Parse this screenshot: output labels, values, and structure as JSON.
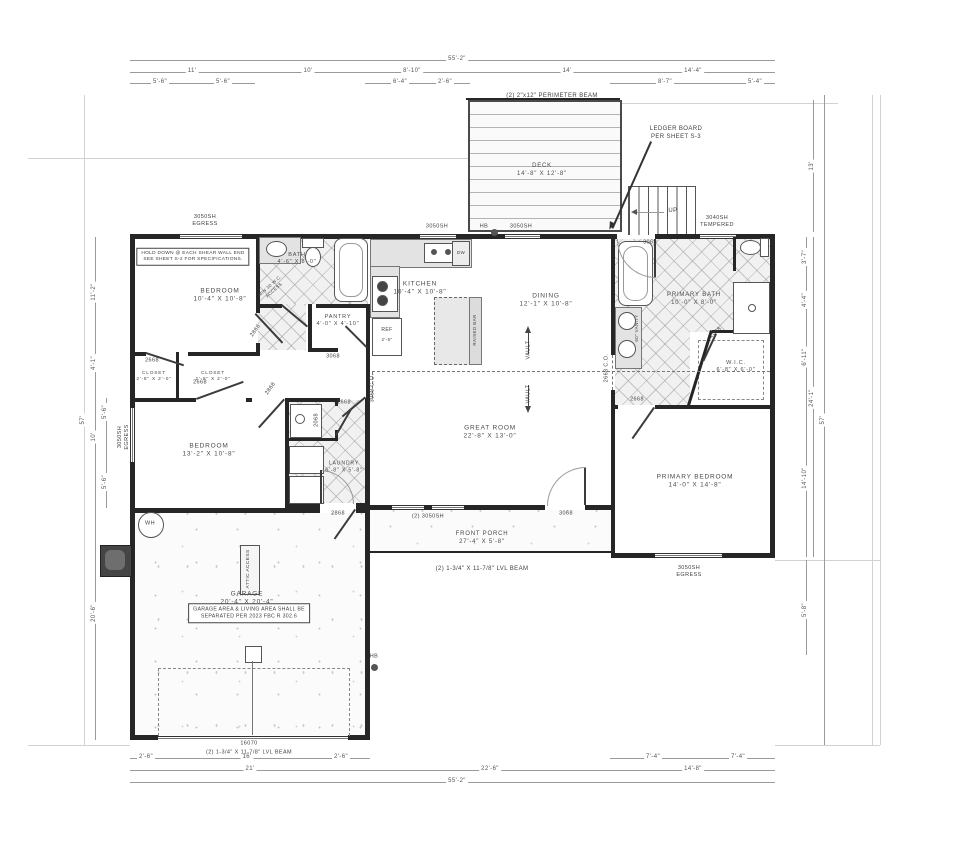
{
  "summary": {
    "rooms": [
      {
        "name": "BEDROOM",
        "size": "10'-4\" X 10'-8\""
      },
      {
        "name": "BATH",
        "size": "4'-6\" X 8'-0\""
      },
      {
        "name": "PANTRY",
        "size": "4'-0\" X 4'-10\""
      },
      {
        "name": "KITCHEN",
        "size": "10'-4\" X 10'-8\""
      },
      {
        "name": "DINING",
        "size": "12'-1\" X 10'-8\""
      },
      {
        "name": "GREAT ROOM",
        "size": "22'-8\" X 13'-0\""
      },
      {
        "name": "PRIMARY BATH",
        "size": "10'-0\" X 8'-0\""
      },
      {
        "name": "W.I.C.",
        "size": "6'-8\" X 6'-0\""
      },
      {
        "name": "PRIMARY BEDROOM",
        "size": "14'-0\" X 14'-8\""
      },
      {
        "name": "BEDROOM",
        "size": "13'-2\" X 10'-8\""
      },
      {
        "name": "CLOSET",
        "size": "2'-8\" X 2'-0\""
      },
      {
        "name": "CLOSET",
        "size": "2'-8\" X 2'-0\""
      },
      {
        "name": "LAUNDRY",
        "size": "6'-8\" X 5'-8\""
      },
      {
        "name": "GARAGE",
        "size": "20'-4\" X 20'-4\""
      },
      {
        "name": "FRONT PORCH",
        "size": "27'-4\" X 5'-8\""
      },
      {
        "name": "DECK",
        "size": "14'-8\" X 12'-8\""
      }
    ],
    "notes": [
      "HOLD DOWN @ EACH SHEAR WALL END SEE SHEET S-2 FOR SPECIFICATIONS.",
      "GARAGE AREA & LIVING AREA SHALL BE SEPARATED PER 2023 FBC R 302.6",
      "LEDGER BOARD PER SHEET S-3",
      "(2) 2\"x12\" PERIMETER BEAM",
      "(2) 1-3/4\" X 11-7/8\" LVL BEAM"
    ],
    "windows": [
      "3050SH EGRESS",
      "3050SH",
      "3040SH TEMPERED",
      "(2) 3050SH"
    ],
    "doors": [
      "3068",
      "2868",
      "2668",
      "2068",
      "16070",
      "2668 C.O.",
      "3068 C.O."
    ],
    "symbols": [
      "HB",
      "WH",
      "DW",
      "REF",
      "UP",
      "VAULT",
      "RAISED BAR",
      "ATTIC ACCESS",
      "MIN 30 W.C. ACCESS",
      "60\" VANITY"
    ]
  },
  "labels": [
    {
      "t": "55'-2\"",
      "x": 457,
      "y": 60,
      "s": 6,
      "c": "dim",
      "n": "dim-overall-top"
    },
    {
      "t": "11'",
      "x": 192,
      "y": 72,
      "s": 6,
      "c": "dim",
      "n": "dim"
    },
    {
      "t": "10'",
      "x": 308,
      "y": 72,
      "s": 6,
      "c": "dim",
      "n": "dim"
    },
    {
      "t": "8'-10\"",
      "x": 412,
      "y": 72,
      "s": 6,
      "c": "dim",
      "n": "dim"
    },
    {
      "t": "14'",
      "x": 567,
      "y": 72,
      "s": 6,
      "c": "dim",
      "n": "dim"
    },
    {
      "t": "14'-4\"",
      "x": 693,
      "y": 72,
      "s": 6,
      "c": "dim",
      "n": "dim"
    },
    {
      "t": "5'-6\"",
      "x": 160,
      "y": 83,
      "s": 6,
      "c": "dim",
      "n": "dim"
    },
    {
      "t": "5'-6\"",
      "x": 223,
      "y": 83,
      "s": 6,
      "c": "dim",
      "n": "dim"
    },
    {
      "t": "6'-4\"",
      "x": 400,
      "y": 83,
      "s": 6,
      "c": "dim",
      "n": "dim"
    },
    {
      "t": "2'-6\"",
      "x": 445,
      "y": 83,
      "s": 6,
      "c": "dim",
      "n": "dim"
    },
    {
      "t": "8'-7\"",
      "x": 665,
      "y": 83,
      "s": 6,
      "c": "dim",
      "n": "dim"
    },
    {
      "t": "5'-4\"",
      "x": 755,
      "y": 83,
      "s": 6,
      "c": "dim",
      "n": "dim"
    },
    {
      "t": "2'-6\"",
      "x": 146,
      "y": 758,
      "s": 6,
      "c": "dim",
      "n": "dim"
    },
    {
      "t": "16'",
      "x": 247,
      "y": 758,
      "s": 6,
      "c": "dim",
      "n": "dim"
    },
    {
      "t": "2'-6\"",
      "x": 341,
      "y": 758,
      "s": 6,
      "c": "dim",
      "n": "dim"
    },
    {
      "t": "21'",
      "x": 250,
      "y": 770,
      "s": 6,
      "c": "dim",
      "n": "dim"
    },
    {
      "t": "7'-4\"",
      "x": 653,
      "y": 758,
      "s": 6,
      "c": "dim",
      "n": "dim"
    },
    {
      "t": "7'-4\"",
      "x": 738,
      "y": 758,
      "s": 6,
      "c": "dim",
      "n": "dim"
    },
    {
      "t": "22'-6\"",
      "x": 490,
      "y": 770,
      "s": 6,
      "c": "dim",
      "n": "dim"
    },
    {
      "t": "14'-8\"",
      "x": 693,
      "y": 770,
      "s": 6,
      "c": "dim",
      "n": "dim"
    },
    {
      "t": "55'-2\"",
      "x": 457,
      "y": 782,
      "s": 6,
      "c": "dim",
      "n": "dim-overall-bottom"
    },
    {
      "t": "57'",
      "x": 84,
      "y": 420,
      "s": 6,
      "r": -90,
      "c": "dim",
      "n": "dim-overall-left"
    },
    {
      "t": "11'-2\"",
      "x": 95,
      "y": 292,
      "s": 6,
      "r": -90,
      "c": "dim",
      "n": "dim"
    },
    {
      "t": "4'-1\"",
      "x": 95,
      "y": 363,
      "s": 6,
      "r": -90,
      "c": "dim",
      "n": "dim"
    },
    {
      "t": "10'",
      "x": 95,
      "y": 437,
      "s": 6,
      "r": -90,
      "c": "dim",
      "n": "dim"
    },
    {
      "t": "20'-6\"",
      "x": 95,
      "y": 613,
      "s": 6,
      "r": -90,
      "c": "dim",
      "n": "dim"
    },
    {
      "t": "5'-6\"",
      "x": 106,
      "y": 412,
      "s": 6,
      "r": -90,
      "c": "dim",
      "n": "dim"
    },
    {
      "t": "5'-6\"",
      "x": 106,
      "y": 482,
      "s": 6,
      "r": -90,
      "c": "dim",
      "n": "dim"
    },
    {
      "t": "13'",
      "x": 813,
      "y": 166,
      "s": 6,
      "r": -90,
      "c": "dim",
      "n": "dim"
    },
    {
      "t": "3'-7\"",
      "x": 806,
      "y": 257,
      "s": 6,
      "r": -90,
      "c": "dim",
      "n": "dim"
    },
    {
      "t": "4'-4\"",
      "x": 806,
      "y": 300,
      "s": 6,
      "r": -90,
      "c": "dim",
      "n": "dim"
    },
    {
      "t": "6'-11\"",
      "x": 806,
      "y": 357,
      "s": 6,
      "r": -90,
      "c": "dim",
      "n": "dim"
    },
    {
      "t": "24'-1\"",
      "x": 813,
      "y": 398,
      "s": 6,
      "r": -90,
      "c": "dim",
      "n": "dim"
    },
    {
      "t": "14'-10\"",
      "x": 806,
      "y": 478,
      "s": 6,
      "r": -90,
      "c": "dim",
      "n": "dim"
    },
    {
      "t": "5'-8\"",
      "x": 806,
      "y": 610,
      "s": 6,
      "r": -90,
      "c": "dim",
      "n": "dim"
    },
    {
      "t": "57'",
      "x": 824,
      "y": 420,
      "s": 6,
      "r": -90,
      "c": "dim",
      "n": "dim-overall-right"
    },
    {
      "t": "3050SH\nEGRESS",
      "x": 205,
      "y": 221,
      "s": 5.5,
      "n": "window-tag"
    },
    {
      "t": "3050SH",
      "x": 437,
      "y": 227,
      "s": 5.5,
      "n": "window-tag"
    },
    {
      "t": "HB",
      "x": 484,
      "y": 227,
      "s": 5.5,
      "n": "hose-bib-tag"
    },
    {
      "t": "3050SH",
      "x": 521,
      "y": 227,
      "s": 5.5,
      "n": "window-tag"
    },
    {
      "t": "3068",
      "x": 650,
      "y": 243,
      "s": 5.5,
      "n": "door-tag"
    },
    {
      "t": "3040SH\nTEMPERED",
      "x": 717,
      "y": 222,
      "s": 5.5,
      "n": "window-tag"
    },
    {
      "t": "3050SH\nEGRESS",
      "x": 124,
      "y": 437,
      "s": 5.5,
      "r": -90,
      "n": "window-tag"
    },
    {
      "t": "(2) 3050SH",
      "x": 428,
      "y": 517,
      "s": 5.5,
      "n": "window-tag"
    },
    {
      "t": "3068",
      "x": 566,
      "y": 514,
      "s": 5.5,
      "n": "door-tag"
    },
    {
      "t": "3050SH\nEGRESS",
      "x": 689,
      "y": 572,
      "s": 5.5,
      "n": "window-tag"
    },
    {
      "t": "2868",
      "x": 256,
      "y": 331,
      "s": 5.5,
      "r": -55,
      "n": "door-tag"
    },
    {
      "t": "2868",
      "x": 271,
      "y": 389,
      "s": 5.5,
      "r": -55,
      "n": "door-tag"
    },
    {
      "t": "2668",
      "x": 152,
      "y": 361,
      "s": 5.5,
      "n": "door-tag"
    },
    {
      "t": "2668",
      "x": 200,
      "y": 383,
      "s": 5.5,
      "n": "door-tag"
    },
    {
      "t": "2068",
      "x": 716,
      "y": 333,
      "s": 5.5,
      "r": -40,
      "n": "door-tag"
    },
    {
      "t": "2668",
      "x": 637,
      "y": 400,
      "s": 5.5,
      "n": "door-tag"
    },
    {
      "t": "2668 C.O.",
      "x": 607,
      "y": 368,
      "s": 5.5,
      "r": -90,
      "n": "opening-tag"
    },
    {
      "t": "3068 C.O.",
      "x": 373,
      "y": 388,
      "s": 5.5,
      "r": -90,
      "n": "opening-tag"
    },
    {
      "t": "2068",
      "x": 317,
      "y": 420,
      "s": 5.5,
      "r": -90,
      "n": "door-tag"
    },
    {
      "t": "2668",
      "x": 344,
      "y": 403,
      "s": 5.5,
      "n": "door-tag"
    },
    {
      "t": "3068",
      "x": 333,
      "y": 357,
      "s": 5.5,
      "n": "door-tag"
    },
    {
      "t": "2868",
      "x": 338,
      "y": 514,
      "s": 5.5,
      "n": "door-tag"
    },
    {
      "t": "16070",
      "x": 249,
      "y": 744,
      "s": 5.5,
      "n": "garage-door-tag"
    },
    {
      "t": "HB",
      "x": 374,
      "y": 657,
      "s": 5.5,
      "n": "hose-bib-tag"
    },
    {
      "t": "BEDROOM\n10'-4\" X 10'-8\"",
      "x": 220,
      "y": 296,
      "s": 6.5,
      "c": "room",
      "n": "room-label-bedroom-1"
    },
    {
      "t": "BATH\n4'-6\" X 8'-0\"",
      "x": 297,
      "y": 259,
      "s": 5.5,
      "c": "room",
      "n": "room-label-bath"
    },
    {
      "t": "PANTRY\n4'-0\" X 4'-10\"",
      "x": 338,
      "y": 321,
      "s": 5.5,
      "c": "room",
      "n": "room-label-pantry"
    },
    {
      "t": "KITCHEN\n10'-4\" X 10'-8\"",
      "x": 420,
      "y": 289,
      "s": 6.5,
      "c": "room",
      "n": "room-label-kitchen"
    },
    {
      "t": "DINING\n12'-1\" X 10'-8\"",
      "x": 546,
      "y": 301,
      "s": 6.5,
      "c": "room",
      "n": "room-label-dining"
    },
    {
      "t": "GREAT ROOM\n22'-8\" X 13'-0\"",
      "x": 490,
      "y": 433,
      "s": 6.5,
      "c": "room",
      "n": "room-label-great-room"
    },
    {
      "t": "PRIMARY BATH\n10'-0\" X 8'-0\"",
      "x": 694,
      "y": 300,
      "s": 6,
      "c": "room",
      "n": "room-label-primary-bath"
    },
    {
      "t": "W.I.C.\n6'-8\" X 6'-0\"",
      "x": 736,
      "y": 367,
      "s": 5.5,
      "c": "room",
      "n": "room-label-wic"
    },
    {
      "t": "PRIMARY BEDROOM\n14'-0\" X 14'-8\"",
      "x": 695,
      "y": 482,
      "s": 6.5,
      "c": "room",
      "n": "room-label-primary-bedroom"
    },
    {
      "t": "BEDROOM\n13'-2\" X 10'-8\"",
      "x": 209,
      "y": 451,
      "s": 6.5,
      "c": "room",
      "n": "room-label-bedroom-2"
    },
    {
      "t": "CLOSET\n2'-8\" X 2'-0\"",
      "x": 154,
      "y": 377,
      "s": 4.8,
      "c": "room",
      "n": "room-label-closet-1"
    },
    {
      "t": "CLOSET\n2'-8\" X 2'-0\"",
      "x": 213,
      "y": 377,
      "s": 4.8,
      "c": "room",
      "n": "room-label-closet-2"
    },
    {
      "t": "LAUNDRY\n6'-8\" X 5'-8\"",
      "x": 344,
      "y": 467,
      "s": 5.2,
      "c": "room",
      "n": "room-label-laundry"
    },
    {
      "t": "GARAGE\n20'-4\" X 20'-4\"",
      "x": 247,
      "y": 599,
      "s": 6.5,
      "c": "room",
      "n": "room-label-garage"
    },
    {
      "t": "FRONT PORCH\n27'-4\" X 5'-8\"",
      "x": 482,
      "y": 539,
      "s": 6,
      "c": "room",
      "n": "room-label-front-porch"
    },
    {
      "t": "DECK\n14'-8\" X 12'-8\"",
      "x": 542,
      "y": 171,
      "s": 6,
      "c": "room",
      "n": "room-label-deck"
    },
    {
      "t": "HOLD DOWN @ EACH SHEAR WALL END\nSEE SHEET S-2 FOR SPECIFICATIONS.",
      "x": 193,
      "y": 257,
      "s": 4.8,
      "c": "note",
      "n": "note-hold-down"
    },
    {
      "t": "GARAGE AREA & LIVING AREA SHALL BE\nSEPARATED PER 2023 FBC R 302.6",
      "x": 249,
      "y": 613,
      "s": 5.2,
      "c": "note",
      "n": "note-garage-separation"
    },
    {
      "t": "LEDGER BOARD\nPER SHEET S-3",
      "x": 676,
      "y": 134,
      "s": 6,
      "n": "note-ledger-board"
    },
    {
      "t": "(2) 2\"x12\" PERIMETER BEAM",
      "x": 552,
      "y": 97,
      "s": 6,
      "n": "note-perimeter-beam"
    },
    {
      "t": "(2) 1-3/4\" X 11-7/8\" LVL BEAM",
      "x": 482,
      "y": 570,
      "s": 6,
      "n": "note-porch-beam"
    },
    {
      "t": "(2) 1-3/4\" X 11-7/8\" LVL BEAM",
      "x": 249,
      "y": 753,
      "s": 5.5,
      "n": "note-garage-beam"
    },
    {
      "t": "UP",
      "x": 673,
      "y": 212,
      "s": 6,
      "n": "stair-up-label"
    },
    {
      "t": "WH",
      "x": 150,
      "y": 524,
      "s": 5.5,
      "n": "water-heater-label"
    },
    {
      "t": "DW",
      "x": 461,
      "y": 253,
      "s": 4.5,
      "n": "dishwasher-label"
    },
    {
      "t": "REF",
      "x": 387,
      "y": 330,
      "s": 5,
      "n": "fridge-label"
    },
    {
      "t": "2'-6\"",
      "x": 387,
      "y": 340,
      "s": 4.5,
      "n": "fridge-dim"
    },
    {
      "t": "RAISED BAR",
      "x": 475,
      "y": 330,
      "s": 4.5,
      "r": -90,
      "n": "raised-bar-label"
    },
    {
      "t": "VAULT",
      "x": 529,
      "y": 350,
      "s": 5.5,
      "r": -90,
      "n": "vault-label"
    },
    {
      "t": "VAULT",
      "x": 529,
      "y": 394,
      "s": 5.5,
      "r": -90,
      "n": "vault-label"
    },
    {
      "t": "ATTIC ACCESS",
      "x": 249,
      "y": 569,
      "s": 4.8,
      "r": -90,
      "n": "attic-access-label"
    },
    {
      "t": "MIN 30 W.C.\nACCESS",
      "x": 272,
      "y": 288,
      "s": 4.4,
      "r": -42,
      "n": "wc-access-note"
    },
    {
      "t": "60\" VANITY",
      "x": 637,
      "y": 328,
      "s": 4.4,
      "r": -90,
      "n": "vanity-label"
    }
  ]
}
